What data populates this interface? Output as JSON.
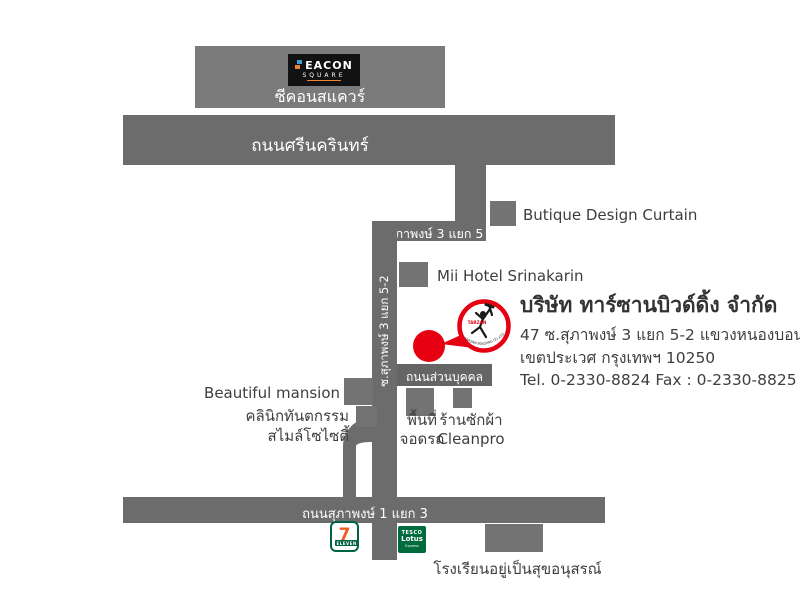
{
  "map": {
    "colors": {
      "road": "#6c6c6c",
      "building": "#737373",
      "seacon_building": "#7b7b7b",
      "accent_red": "#e60012",
      "label_dark": "#3e3e3e",
      "label_white": "#ffffff",
      "seven_green": "#006341",
      "seven_orange": "#f15a22",
      "tesco_green": "#006b3c"
    },
    "seacon": {
      "logo_line1": "EACON",
      "logo_line2": "SQUARE",
      "name": "ซีคอนสแควร์"
    },
    "roads": {
      "srinakarin": "ถนนศรีนครินทร์",
      "soi5": "ซ.สุภาพงษ์ 3 แยก 5",
      "soi52": "ซ.สุภาพงษ์ 3 แยก 5-2",
      "private": "ถนนส่วนบุคคล",
      "soi1": "ถนนสุภาพงษ์ 1 แยก 3"
    },
    "places": {
      "butique": "Butique Design Curtain",
      "mii_hotel": "Mii Hotel Srinakarin",
      "beautiful_mansion": "Beautiful mansion",
      "clinic_line1": "คลินิกทันตกรรม",
      "clinic_line2": "สไมล์โซไซตี้",
      "parking_line1": "พื้นที่",
      "parking_line2": "จอดรถ",
      "laundry_line1": "ร้านซักผ้า",
      "laundry_line2": "Cleanpro",
      "school": "โรงเรียนอยู่เป็นสุขอนุสรณ์",
      "seven_eleven_number": "7",
      "seven_eleven_band": "ELEVEN",
      "tesco_line1": "TESCO",
      "tesco_line2": "Lotus",
      "tesco_line3": "Express"
    },
    "company": {
      "name": "บริษัท ทาร์ซานบิวด์ดิ้ง จำกัด",
      "address_line1": "47 ซ.สุภาพงษ์ 3 แยก 5-2 แขวงหนองบอน",
      "address_line2": "เขตประเวศ กรุงเทพฯ 10250",
      "contact": "Tel. 0-2330-8824 Fax : 0-2330-8825",
      "logo_text_top": "TARZAN",
      "logo_text_arc": "TARZAN BUILDING CO.,LTD."
    }
  }
}
